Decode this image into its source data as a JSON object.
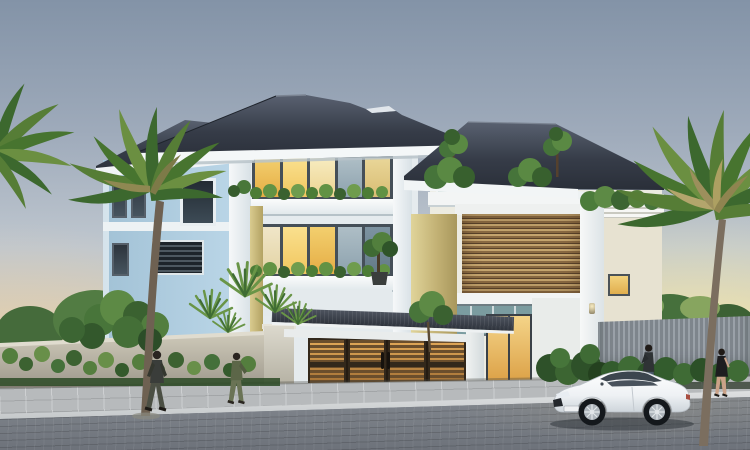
{
  "scene": {
    "title": "Modern villa exterior rendering at dusk",
    "description": "3D architectural rendering of a three-storey modern villa at sunset: dark hip roofs, light-blue and white walls with khaki accent columns, warm lit windows, glass balcony railings with planters, a wooden louver screen, a slatted wooden entrance gate with canopy, concrete boundary wall with climbing plants, palm trees, four pedestrians and a white coupe parked on a stone-paved street.",
    "time_of_day": "dusk"
  },
  "palette": {
    "sky_top": "#8393a7",
    "sky_mid": "#bfc7cf",
    "sky_horizon_glow": "#f4e6ac",
    "roof_dark": "#3a404b",
    "fascia_white": "#f4f6f7",
    "wall_light_blue": "#b7d2e4",
    "wall_white": "#eef1f3",
    "accent_khaki": "#d2c285",
    "window_lit": "#f6d27a",
    "window_frame": "#454f58",
    "wood_louver": "#8a6a42",
    "gate_wood": "#c08440",
    "gate_glow": "#e2a958",
    "boundary_wall": "#b3aea0",
    "foliage_dark": "#2f5230",
    "foliage_light": "#6f9c4e",
    "sidewalk": "#b7babc",
    "road": "#7d828a",
    "car_body": "#f2f4f6"
  },
  "objects": {
    "house": {
      "label": "three-storey modern villa",
      "storeys": 3,
      "features": [
        "hip roofs",
        "glass balcony railings",
        "balcony planter boxes",
        "wooden louver screen",
        "rooftop terrace plants",
        "lit interior windows",
        "khaki accent columns",
        "louvered vent panel"
      ]
    },
    "gate": {
      "label": "wooden slatted entrance gate",
      "leaf_count": 4,
      "canopy": "dark tiled canopy with white fascia"
    },
    "boundary_wall": {
      "label": "concrete boundary wall with climbing plants"
    },
    "fence": {
      "label": "grey slatted fence with hedge"
    },
    "car": {
      "label": "white coupe parked on street, facing left"
    },
    "people": [
      {
        "label": "man walking on left sidewalk"
      },
      {
        "label": "woman walking near boundary wall"
      },
      {
        "label": "man standing behind parked car"
      },
      {
        "label": "woman walking on right sidewalk"
      }
    ],
    "trees": {
      "palms": [
        "far-left palm fronds",
        "left palm tree",
        "tall right palm tree"
      ],
      "other": "leafy trees, shrubs, fan plants and hedges"
    },
    "street": {
      "sidewalk": "grey paver sidewalk",
      "curb": "light curb stones",
      "road": "dark stone-paved road"
    }
  }
}
